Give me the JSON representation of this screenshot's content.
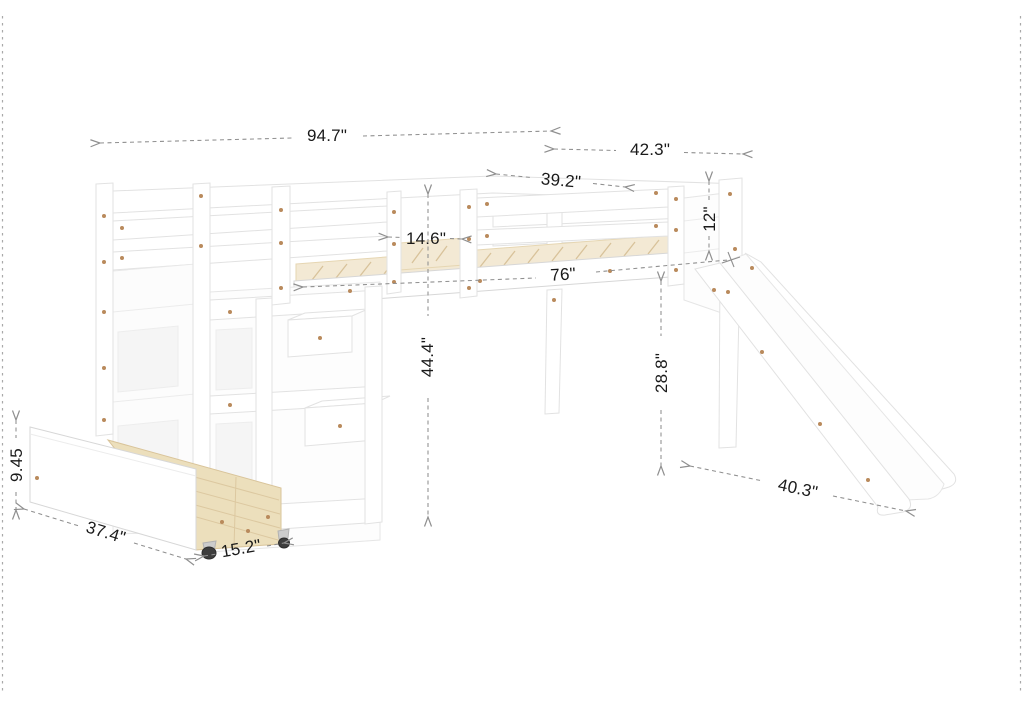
{
  "page": {
    "background": "#ffffff",
    "kind": "product-dimension-diagram",
    "subject": "White loft bed with staircase storage shelves, rolling under-bed drawer and slide"
  },
  "diagram": {
    "unit": "inches",
    "colors": {
      "furniture_fill": "#ffffff",
      "furniture_outline": "#e2e2e2",
      "slat_wood": "#f3e9d4",
      "drawer_wood": "#ecdfbc",
      "screw": "#b98a5c",
      "dimension_line": "#8f8f8f",
      "dimension_text": "#1a1a1a",
      "border_dash": "#a9a9a9"
    },
    "dimensions": [
      {
        "name": "overall-length",
        "label": "94.7\""
      },
      {
        "name": "overall-depth",
        "label": "42.3\""
      },
      {
        "name": "bed-top-width",
        "label": "39.2\""
      },
      {
        "name": "guardrail-opening",
        "label": "14.6\""
      },
      {
        "name": "guardrail-height",
        "label": "12\""
      },
      {
        "name": "sleeping-surface-length",
        "label": "76\""
      },
      {
        "name": "overall-height",
        "label": "44.4\""
      },
      {
        "name": "under-bed-clearance",
        "label": "28.8\""
      },
      {
        "name": "slide-length",
        "label": "40.3\""
      },
      {
        "name": "drawer-length",
        "label": "37.4\""
      },
      {
        "name": "drawer-depth",
        "label": "15.2\""
      },
      {
        "name": "drawer-height",
        "label": "9.45"
      }
    ]
  }
}
